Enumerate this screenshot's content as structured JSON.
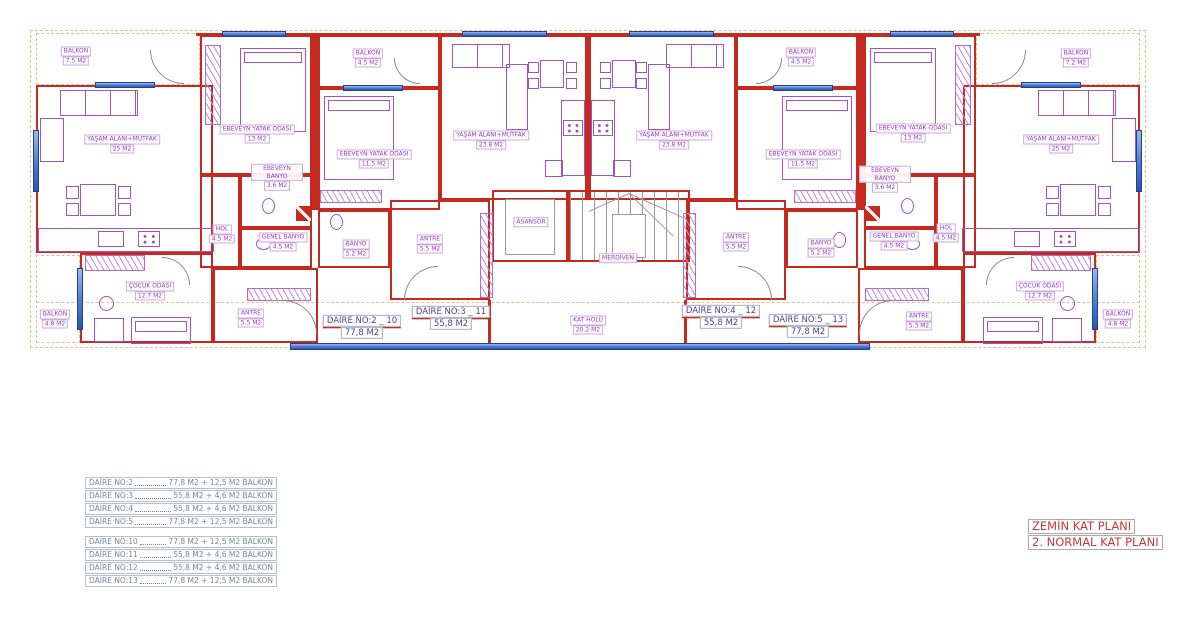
{
  "plan": {
    "rooms": [
      {
        "name": "BALKON",
        "area": "7.5 M2"
      },
      {
        "name": "YAŞAM ALANI+MUTFAK",
        "area": "25 M2"
      },
      {
        "name": "EBEVEYN YATAK ODASI",
        "area": "13 M2"
      },
      {
        "name": "EBEVEYN BANYO",
        "area": "3.6 M2"
      },
      {
        "name": "HOL",
        "area": "4.5 M2"
      },
      {
        "name": "GENEL BANYO",
        "area": "4.5 M2"
      },
      {
        "name": "BANYO",
        "area": "5.2 M2"
      },
      {
        "name": "ANTRE",
        "area": "5.5 M2"
      },
      {
        "name": "ÇOCUK ODASI",
        "area": "12.7 M2"
      },
      {
        "name": "BALKON",
        "area": "4.8 M2"
      },
      {
        "name": "BALKON",
        "area": "4.5 M2"
      },
      {
        "name": "EBEVEYN YATAK ODASI",
        "area": "11.5 M2"
      },
      {
        "name": "YAŞAM ALANI+MUTFAK",
        "area": "23.8 M2"
      },
      {
        "name": "ANTRE",
        "area": "5.5 M2"
      },
      {
        "name": "ASANSÖR"
      },
      {
        "name": "MERDİVEN"
      },
      {
        "name": "KAT HOLÜ",
        "area": "20.2 M2"
      },
      {
        "name": "YAŞAM ALANI+MUTFAK",
        "area": "23.8 M2"
      },
      {
        "name": "BALKON",
        "area": "4.5 M2"
      },
      {
        "name": "EBEVEYN YATAK ODASI",
        "area": "11.5 M2"
      },
      {
        "name": "ANTRE",
        "area": "5.5 M2"
      },
      {
        "name": "BANYO",
        "area": "5.2 M2"
      },
      {
        "name": "GENEL BANYO",
        "area": "4.5 M2"
      },
      {
        "name": "EBEVEYN BANYO",
        "area": "3.6 M2"
      },
      {
        "name": "HOL",
        "area": "4.5 M2"
      },
      {
        "name": "EBEVEYN YATAK ODASI",
        "area": "13 M2"
      },
      {
        "name": "BALKON",
        "area": "7.2 M2"
      },
      {
        "name": "YAŞAM ALANI+MUTFAK",
        "area": "25 M2"
      },
      {
        "name": "ÇOCUK ODASI",
        "area": "12.7 M2"
      },
      {
        "name": "BALKON",
        "area": "4.8 M2"
      },
      {
        "name": "ANTRE",
        "area": "5.3 M2"
      }
    ],
    "units": [
      {
        "label": "DAİRE NO:2 _ 10",
        "area": "77,8 M2"
      },
      {
        "label": "DAİRE NO:3 _ 11",
        "area": "55,8 M2"
      },
      {
        "label": "DAİRE NO:4 _ 12",
        "area": "55,8 M2"
      },
      {
        "label": "DAİRE NO:5 _ 13",
        "area": "77,8 M2"
      }
    ]
  },
  "legend": {
    "block1": [
      {
        "label": "DAİRE NO:2",
        "value": "77,8 M2 + 12,5 M2 BALKON"
      },
      {
        "label": "DAİRE NO:3",
        "value": "55,8 M2 + 4,6 M2 BALKON"
      },
      {
        "label": "DAİRE NO:4",
        "value": "55,8 M2 + 4,6 M2 BALKON"
      },
      {
        "label": "DAİRE NO:5",
        "value": "77,8 M2 + 12,5 M2 BALKON"
      }
    ],
    "block2": [
      {
        "label": "DAİRE NO:10",
        "value": "77,8 M2 + 12,5 M2 BALKON"
      },
      {
        "label": "DAİRE NO:11",
        "value": "55,8 M2 + 4,6 M2 BALKON"
      },
      {
        "label": "DAİRE NO:12",
        "value": "55,8 M2 + 4,6 M2 BALKON"
      },
      {
        "label": "DAİRE NO:13",
        "value": "77,8 M2 + 12,5 M2 BALKON"
      }
    ]
  },
  "titlebox": {
    "line1": "ZEMİN KAT PLANI",
    "line2": "2. NORMAL KAT PLANI"
  },
  "colors": {
    "wall": "#c5291f",
    "furniture": "#a052c8",
    "window_fill": "#4a7bd0",
    "boundary": "#d9c48c",
    "room_label": "#9a35c0",
    "unit_label": "#474492",
    "legend_text": "#76879d",
    "title_text": "#c4393b"
  }
}
